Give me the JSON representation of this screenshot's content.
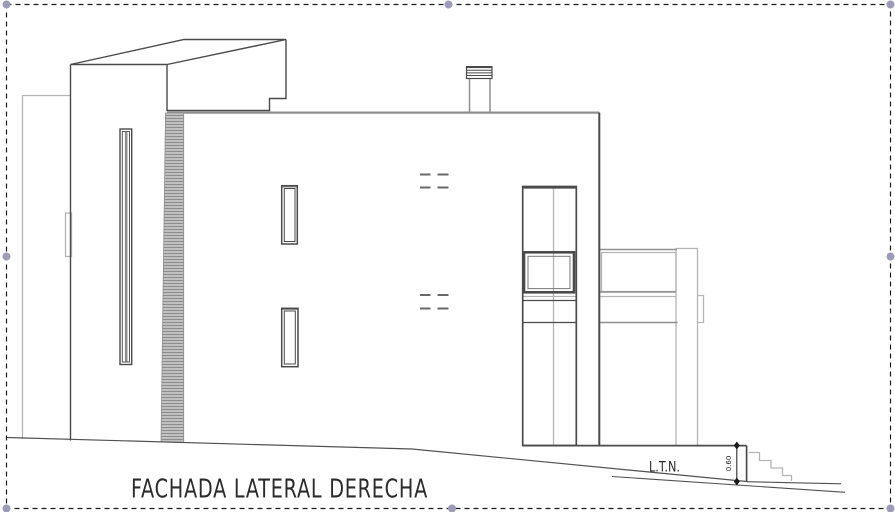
{
  "annotations": {
    "title": "FACHADA LATERAL DERECHA",
    "terrain_label": "L.T.N.",
    "stair_dimension": "0.60"
  },
  "selection": {
    "handle_color": "#9c9cba",
    "border_color": "#1c1c1c"
  },
  "palette": {
    "dark_line": "#4a4a4a",
    "medium_line": "#8f8f8f",
    "light_line": "#b5b5b5",
    "hatch_line": "#8d8d8d",
    "hatch_base": "#c9c9c9",
    "text_color": "#2b2b2b",
    "dimension_color": "#1a1a1a",
    "background": "#ffffff"
  }
}
